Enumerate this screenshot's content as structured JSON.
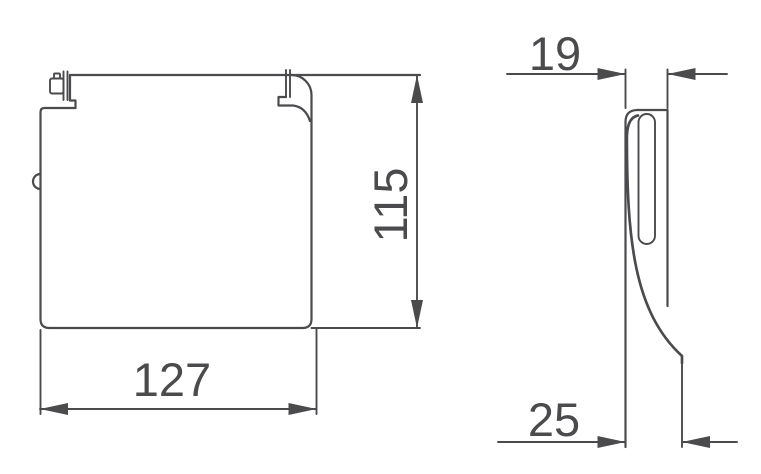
{
  "colors": {
    "line": "#4b4b4e",
    "background": "#ffffff"
  },
  "front_view": {
    "width_label": "127",
    "height_label": "115"
  },
  "side_view": {
    "top_width_label": "19",
    "bottom_width_label": "25"
  }
}
